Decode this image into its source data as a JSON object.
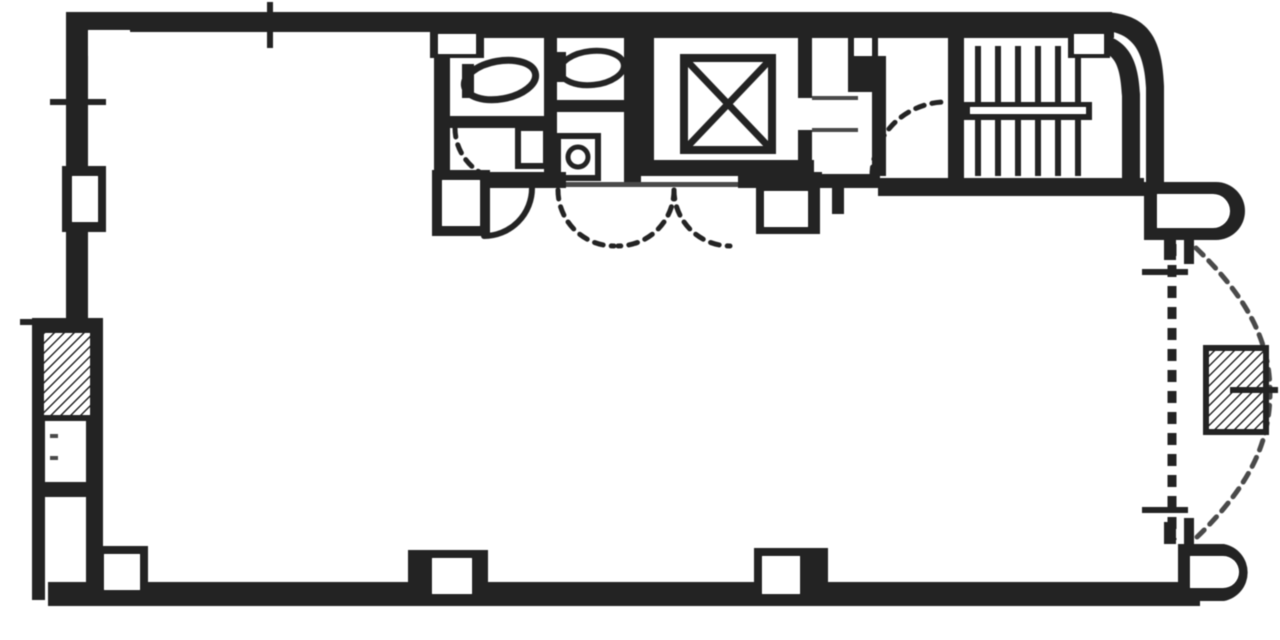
{
  "meta": {
    "description": "scanned black-and-white architectural floor plan of one building storey",
    "colors": {
      "ink": "#2a2a2a",
      "soft": "#4d4d4d",
      "bg": "#ffffff"
    },
    "canvas": {
      "w": 1280,
      "h": 640
    }
  },
  "plan": {
    "layers": [
      {
        "name": "outer-walls",
        "items": [
          {
            "t": "rect",
            "n": "top-wall",
            "x": 66,
            "y": 12,
            "w": 1046,
            "h": 20
          },
          {
            "t": "rect",
            "n": "left-wall",
            "x": 66,
            "y": 12,
            "w": 22,
            "h": 306
          },
          {
            "t": "rect",
            "n": "bottom-wall",
            "x": 48,
            "y": 582,
            "w": 1152,
            "h": 24
          },
          {
            "t": "path",
            "n": "rounded-corner-wall",
            "d": "M1104,12 C1150,14 1162,40 1164,86 L1164,186 L1146,186 L1146,88 C1144,52 1134,32 1100,30 L1100,12 Z"
          },
          {
            "t": "path",
            "n": "round-bay-top",
            "d": "M1144,182 L1216,182 A29,29 0 0 1 1216,240 L1144,240 Z"
          },
          {
            "t": "path",
            "n": "round-bay-top-inset",
            "d": "M1157,194 L1213,194 A17,17 0 0 1 1213,228 L1157,228 Z",
            "f": "bg"
          },
          {
            "t": "path",
            "n": "round-bay-bottom",
            "d": "M1178,544 L1224,544 A29,29 0 0 1 1224,601 L1178,601 Z"
          },
          {
            "t": "path",
            "n": "round-bay-bottom-inset",
            "d": "M1190,556 L1223,556 A16,16 0 0 1 1223,588 L1190,588 Z",
            "f": "bg"
          },
          {
            "t": "rect",
            "n": "right-stub-1",
            "x": 1164,
            "y": 240,
            "w": 12,
            "h": 20
          },
          {
            "t": "rect",
            "n": "right-stub-2",
            "x": 1184,
            "y": 240,
            "w": 10,
            "h": 24
          },
          {
            "t": "rect",
            "n": "right-stub-3",
            "x": 1164,
            "y": 522,
            "w": 12,
            "h": 22
          },
          {
            "t": "rect",
            "n": "right-stub-4",
            "x": 1184,
            "y": 518,
            "w": 10,
            "h": 26
          },
          {
            "t": "rect",
            "n": "corner-column-inset",
            "x": 88,
            "y": 30,
            "w": 42,
            "h": 26,
            "f": "bg"
          }
        ]
      },
      {
        "name": "left-bay",
        "items": [
          {
            "t": "rect",
            "n": "bay-outer-wall",
            "x": 32,
            "y": 318,
            "w": 13,
            "h": 282
          },
          {
            "t": "rect",
            "n": "bay-top-wall",
            "x": 32,
            "y": 318,
            "w": 56,
            "h": 13
          },
          {
            "t": "rect",
            "n": "bay-inner-wall",
            "x": 86,
            "y": 318,
            "w": 17,
            "h": 264
          },
          {
            "t": "rect",
            "n": "bay-divider-wall",
            "x": 44,
            "y": 482,
            "w": 50,
            "h": 15
          },
          {
            "t": "hatch",
            "n": "shaft-hatch-box",
            "x": 41,
            "y": 330,
            "w": 52,
            "h": 88
          },
          {
            "t": "line",
            "n": "bay-dash-1",
            "x1": 50,
            "y1": 436,
            "x2": 58,
            "y2": 436,
            "sw": 4,
            "c": "soft"
          },
          {
            "t": "line",
            "n": "bay-dash-2",
            "x1": 50,
            "y1": 458,
            "x2": 58,
            "y2": 458,
            "sw": 4,
            "c": "soft"
          }
        ]
      },
      {
        "name": "service-core-walls",
        "items": [
          {
            "t": "rect",
            "n": "core-top-underline",
            "x": 434,
            "y": 30,
            "w": 680,
            "h": 8
          },
          {
            "t": "rect",
            "n": "toilet-left-wall",
            "x": 434,
            "y": 30,
            "w": 16,
            "h": 152
          },
          {
            "t": "rect",
            "n": "toilet-stall-divider",
            "x": 544,
            "y": 38,
            "w": 13,
            "h": 134
          },
          {
            "t": "rect",
            "n": "toilet-elevator-wall",
            "x": 624,
            "y": 28,
            "w": 17,
            "h": 154
          },
          {
            "t": "rect",
            "n": "toilet-partition-left",
            "x": 450,
            "y": 116,
            "w": 94,
            "h": 12
          },
          {
            "t": "rect",
            "n": "toilet-partition-right",
            "x": 557,
            "y": 100,
            "w": 67,
            "h": 12
          },
          {
            "t": "rect",
            "n": "core-bottom-wall-1",
            "x": 434,
            "y": 172,
            "w": 132,
            "h": 16
          },
          {
            "t": "rect",
            "n": "door-sill",
            "x": 566,
            "y": 182,
            "w": 172,
            "h": 5,
            "f": "soft"
          },
          {
            "t": "rect",
            "n": "core-bottom-wall-2",
            "x": 738,
            "y": 172,
            "w": 84,
            "h": 16
          },
          {
            "t": "rect",
            "n": "core-bottom-wall-3",
            "x": 822,
            "y": 174,
            "w": 58,
            "h": 14
          },
          {
            "t": "rect",
            "n": "door-jamb-stub",
            "x": 832,
            "y": 188,
            "w": 12,
            "h": 26
          },
          {
            "t": "rect",
            "n": "hall-right-wall",
            "x": 872,
            "y": 56,
            "w": 14,
            "h": 120
          },
          {
            "t": "rect",
            "n": "hall-pier",
            "x": 848,
            "y": 30,
            "w": 30,
            "h": 62
          },
          {
            "t": "rect",
            "n": "hall-pier-inset",
            "x": 854,
            "y": 38,
            "w": 18,
            "h": 18,
            "f": "bg"
          },
          {
            "t": "rect",
            "n": "stair-left-wall",
            "x": 948,
            "y": 36,
            "w": 16,
            "h": 150
          },
          {
            "t": "rect",
            "n": "stair-bottom-wall",
            "x": 878,
            "y": 178,
            "w": 266,
            "h": 18
          }
        ]
      },
      {
        "name": "elevator",
        "items": [
          {
            "t": "rect",
            "n": "shaft-left-wall",
            "x": 640,
            "y": 28,
            "w": 14,
            "h": 148
          },
          {
            "t": "rect",
            "n": "shaft-right-wall-upper",
            "x": 798,
            "y": 28,
            "w": 14,
            "h": 70
          },
          {
            "t": "rect",
            "n": "shaft-right-wall-lower",
            "x": 798,
            "y": 130,
            "w": 14,
            "h": 46
          },
          {
            "t": "rect",
            "n": "shaft-bottom-wall",
            "x": 640,
            "y": 160,
            "w": 174,
            "h": 16
          },
          {
            "t": "line",
            "n": "door-sill-upper",
            "x1": 812,
            "y1": 98,
            "x2": 858,
            "y2": 98,
            "sw": 4,
            "c": "soft"
          },
          {
            "t": "line",
            "n": "door-sill-lower",
            "x1": 812,
            "y1": 130,
            "x2": 858,
            "y2": 130,
            "sw": 4,
            "c": "soft"
          },
          {
            "t": "srect",
            "n": "elevator-cab",
            "x": 684,
            "y": 58,
            "w": 88,
            "h": 92,
            "sw": 8
          },
          {
            "t": "line",
            "n": "elevator-x-1",
            "x1": 688,
            "y1": 62,
            "x2": 768,
            "y2": 146,
            "sw": 7
          },
          {
            "t": "line",
            "n": "elevator-x-2",
            "x1": 768,
            "y1": 62,
            "x2": 688,
            "y2": 146,
            "sw": 7
          }
        ]
      },
      {
        "name": "staircase",
        "items": [
          {
            "t": "line",
            "n": "tread",
            "x1": 978,
            "y1": 46,
            "x2": 978,
            "y2": 102,
            "sw": 6
          },
          {
            "t": "line",
            "n": "tread",
            "x1": 998,
            "y1": 46,
            "x2": 998,
            "y2": 102,
            "sw": 6
          },
          {
            "t": "line",
            "n": "tread",
            "x1": 1018,
            "y1": 46,
            "x2": 1018,
            "y2": 102,
            "sw": 6
          },
          {
            "t": "line",
            "n": "tread",
            "x1": 1038,
            "y1": 46,
            "x2": 1038,
            "y2": 102,
            "sw": 6
          },
          {
            "t": "line",
            "n": "tread",
            "x1": 1058,
            "y1": 46,
            "x2": 1058,
            "y2": 102,
            "sw": 6
          },
          {
            "t": "line",
            "n": "tread",
            "x1": 1078,
            "y1": 46,
            "x2": 1078,
            "y2": 102,
            "sw": 6
          },
          {
            "t": "rect",
            "n": "stair-mid-rail",
            "x": 964,
            "y": 102,
            "w": 128,
            "h": 18
          },
          {
            "t": "rect",
            "n": "stair-mid-rail-slit",
            "x": 970,
            "y": 107,
            "w": 116,
            "h": 7,
            "f": "bg"
          },
          {
            "t": "line",
            "n": "tread",
            "x1": 978,
            "y1": 120,
            "x2": 978,
            "y2": 176,
            "sw": 6
          },
          {
            "t": "line",
            "n": "tread",
            "x1": 998,
            "y1": 120,
            "x2": 998,
            "y2": 176,
            "sw": 6
          },
          {
            "t": "line",
            "n": "tread",
            "x1": 1018,
            "y1": 120,
            "x2": 1018,
            "y2": 176,
            "sw": 6
          },
          {
            "t": "line",
            "n": "tread",
            "x1": 1038,
            "y1": 120,
            "x2": 1038,
            "y2": 176,
            "sw": 6
          },
          {
            "t": "line",
            "n": "tread",
            "x1": 1058,
            "y1": 120,
            "x2": 1058,
            "y2": 176,
            "sw": 6
          },
          {
            "t": "line",
            "n": "tread",
            "x1": 1078,
            "y1": 120,
            "x2": 1078,
            "y2": 176,
            "sw": 6
          },
          {
            "t": "path",
            "n": "stair-inner-corner-wall",
            "d": "M1090,32 C1128,36 1138,58 1140,94 L1140,178 L1122,178 L1122,96 C1120,62 1114,50 1088,50 L1088,32 Z"
          }
        ]
      },
      {
        "name": "toilet-fixtures",
        "items": [
          {
            "t": "ellipse",
            "n": "wc-bowl",
            "cx": 500,
            "cy": 80,
            "rx": 36,
            "ry": 19,
            "rot": -10,
            "sw": 7
          },
          {
            "t": "rect",
            "n": "wc-tank",
            "x": 462,
            "y": 64,
            "w": 12,
            "h": 34
          },
          {
            "t": "ellipse",
            "n": "wc-bowl",
            "cx": 592,
            "cy": 68,
            "rx": 32,
            "ry": 17,
            "rot": -6,
            "sw": 6
          },
          {
            "t": "rect",
            "n": "wc-tank",
            "x": 556,
            "y": 52,
            "w": 10,
            "h": 30
          },
          {
            "t": "srect",
            "n": "washbasin",
            "x": 518,
            "y": 128,
            "w": 28,
            "h": 38,
            "sw": 6
          },
          {
            "t": "srect",
            "n": "washbasin",
            "x": 558,
            "y": 136,
            "w": 40,
            "h": 42,
            "sw": 6
          },
          {
            "t": "circle",
            "n": "basin-bowl",
            "cx": 578,
            "cy": 157,
            "r": 10,
            "sw": 5
          },
          {
            "t": "arc",
            "n": "toilet-door-arc",
            "d": "M455,128 A52 52 0 0 0 507,180",
            "sw": 5,
            "dash": "9 8"
          }
        ]
      },
      {
        "name": "door-swings",
        "items": [
          {
            "t": "arc",
            "n": "door-arc-solid",
            "d": "M532,188 A48 48 0 0 1 484,236",
            "sw": 6
          },
          {
            "t": "arc",
            "n": "door-arc-dashed",
            "d": "M558,190 A56 56 0 0 0 614,246",
            "sw": 5,
            "dash": "9 8"
          },
          {
            "t": "arc",
            "n": "door-arc-dashed",
            "d": "M674,190 A56 56 0 0 1 618,246",
            "sw": 5,
            "dash": "9 8"
          },
          {
            "t": "arc",
            "n": "door-arc-dashed",
            "d": "M674,190 A56 56 0 0 0 730,246",
            "sw": 5,
            "dash": "9 8"
          },
          {
            "t": "arc",
            "n": "entrance-door-arc",
            "d": "M872,176 A74 74 0 0 1 946,102",
            "sw": 5,
            "dash": "9 8"
          }
        ]
      },
      {
        "name": "columns",
        "items": [
          {
            "t": "rect",
            "n": "pier",
            "x": 432,
            "y": 170,
            "w": 58,
            "h": 66
          },
          {
            "t": "rect",
            "n": "pier-inset",
            "x": 442,
            "y": 180,
            "w": 38,
            "h": 46,
            "f": "bg"
          },
          {
            "t": "rect",
            "n": "pier",
            "x": 756,
            "y": 184,
            "w": 64,
            "h": 50
          },
          {
            "t": "rect",
            "n": "pier-inset",
            "x": 764,
            "y": 191,
            "w": 44,
            "h": 36,
            "f": "bg"
          },
          {
            "t": "rect",
            "n": "pier",
            "x": 62,
            "y": 166,
            "w": 44,
            "h": 66
          },
          {
            "t": "rect",
            "n": "pier-inset",
            "x": 72,
            "y": 176,
            "w": 26,
            "h": 46,
            "f": "bg"
          },
          {
            "t": "rect",
            "n": "pillar",
            "x": 408,
            "y": 550,
            "w": 80,
            "h": 48
          },
          {
            "t": "rect",
            "n": "pillar-inset",
            "x": 432,
            "y": 558,
            "w": 40,
            "h": 36,
            "f": "bg"
          },
          {
            "t": "rect",
            "n": "pillar",
            "x": 754,
            "y": 548,
            "w": 74,
            "h": 50
          },
          {
            "t": "rect",
            "n": "pillar-inset",
            "x": 762,
            "y": 556,
            "w": 38,
            "h": 38,
            "f": "bg"
          },
          {
            "t": "rect",
            "n": "pillar",
            "x": 94,
            "y": 546,
            "w": 54,
            "h": 52
          },
          {
            "t": "rect",
            "n": "pillar-inset",
            "x": 104,
            "y": 554,
            "w": 36,
            "h": 36,
            "f": "bg"
          },
          {
            "t": "rect",
            "n": "wall-notch",
            "x": 430,
            "y": 28,
            "w": 54,
            "h": 30
          },
          {
            "t": "rect",
            "n": "wall-notch-inset",
            "x": 438,
            "y": 34,
            "w": 38,
            "h": 20,
            "f": "bg"
          },
          {
            "t": "rect",
            "n": "wall-notch",
            "x": 1068,
            "y": 28,
            "w": 42,
            "h": 30
          },
          {
            "t": "rect",
            "n": "wall-notch-inset",
            "x": 1074,
            "y": 34,
            "w": 30,
            "h": 20,
            "f": "bg"
          }
        ]
      },
      {
        "name": "window-marks",
        "items": [
          {
            "t": "line",
            "n": "mullion-tick",
            "x1": 270,
            "y1": 2,
            "x2": 270,
            "y2": 48,
            "sw": 6
          },
          {
            "t": "line",
            "n": "mullion-tick",
            "x1": 50,
            "y1": 102,
            "x2": 106,
            "y2": 102,
            "sw": 6
          },
          {
            "t": "line",
            "n": "mullion-tick",
            "x1": 20,
            "y1": 322,
            "x2": 60,
            "y2": 322,
            "sw": 6
          },
          {
            "t": "line",
            "n": "mullion-tick",
            "x1": 1142,
            "y1": 272,
            "x2": 1188,
            "y2": 272,
            "sw": 6
          },
          {
            "t": "line",
            "n": "mullion-tick",
            "x1": 1142,
            "y1": 510,
            "x2": 1188,
            "y2": 510,
            "sw": 6
          },
          {
            "t": "line",
            "n": "window-wall-dashed",
            "x1": 1172,
            "y1": 244,
            "x2": 1172,
            "y2": 540,
            "sw": 9,
            "dash": "12 9"
          }
        ]
      },
      {
        "name": "balcony",
        "items": [
          {
            "t": "arc",
            "n": "balcony-bow-dashed",
            "d": "M1196,248 C1250,300 1270,344 1270,392 C1270,442 1250,486 1196,538",
            "sw": 5,
            "dash": "10 8",
            "c": "soft"
          },
          {
            "t": "hatch",
            "n": "equipment-hatch-box",
            "x": 1206,
            "y": 348,
            "w": 60,
            "h": 84
          },
          {
            "t": "line",
            "n": "equipment-line",
            "x1": 1230,
            "y1": 390,
            "x2": 1278,
            "y2": 390,
            "sw": 6
          }
        ]
      }
    ]
  }
}
